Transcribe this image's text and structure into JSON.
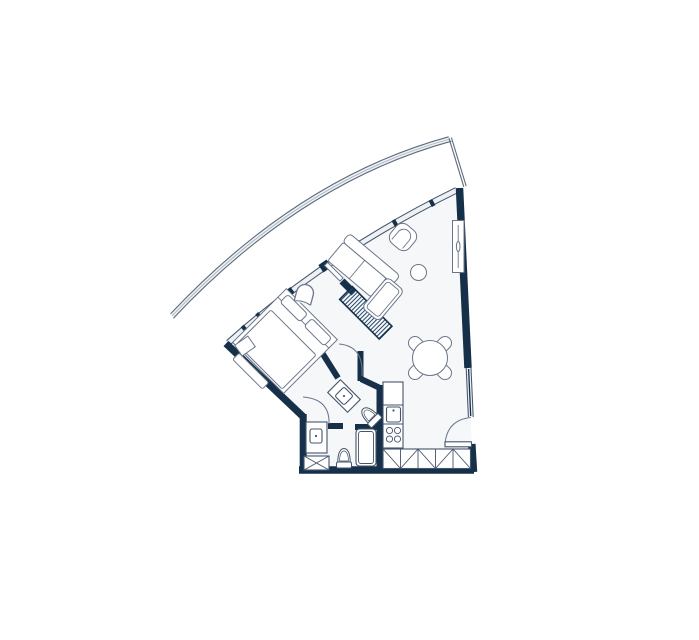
{
  "title": "apartment-floor-plan",
  "canvas": {
    "width": 699,
    "height": 640,
    "background": "#ffffff"
  },
  "colors": {
    "wall": "#16304a",
    "room": "#f5f7f9",
    "glass": "#eef1f4",
    "facade": "#5d6b7c",
    "facademid": "#a9b3bd",
    "furn": "#6a7689",
    "fix": "#44546a"
  }
}
